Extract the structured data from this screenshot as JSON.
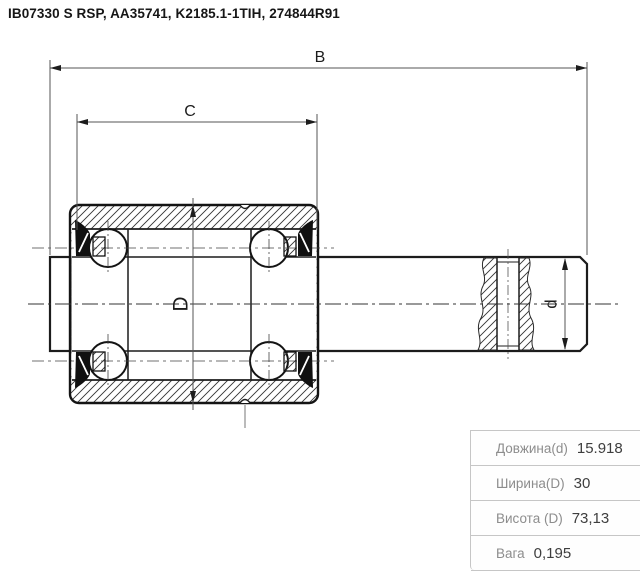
{
  "title": "IB07330 S RSP, AA35741, K2185.1-1TIH, 274844R91",
  "drawing": {
    "type": "bearing cross-section technical drawing",
    "labels": {
      "B": "B",
      "C": "C",
      "D": "D",
      "d": "d"
    }
  },
  "spec_table": {
    "rows": [
      {
        "label": "Довжина(d)",
        "value": "15.918"
      },
      {
        "label": "Ширина(D)",
        "value": "30"
      },
      {
        "label": "Висота (D)",
        "value": "73,13"
      },
      {
        "label": "Вага",
        "value": "0,195"
      }
    ]
  },
  "colors": {
    "line": "#1c1c1c",
    "dim_line": "#555555",
    "table_border": "#c6c6c6",
    "table_label_text": "#8d8d8d",
    "table_value_text": "#3e3e3e",
    "background": "#ffffff"
  }
}
